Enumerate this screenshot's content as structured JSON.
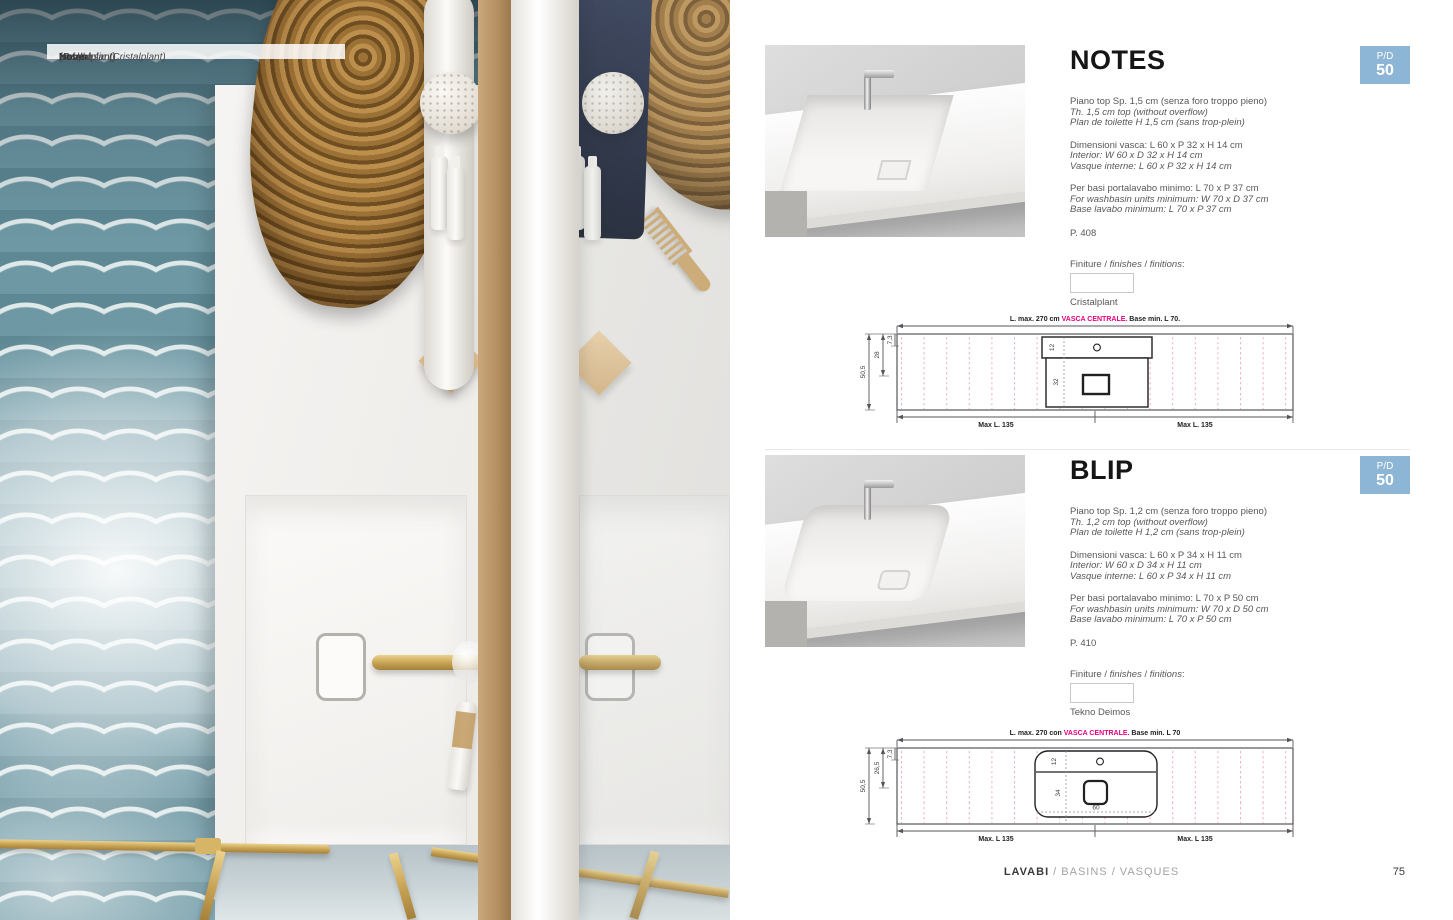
{
  "photo": {
    "caption": {
      "l1a": "Lavabo ",
      "l1b": "Notes",
      "l1c": " (Cristalplant)",
      "l2b": "Notes",
      "l2c": " washbasin (Cristalplant)",
      "l3a": "Vasque ",
      "l3b": "Notes",
      "l3c": " (Cristalplant)"
    }
  },
  "sections": [
    {
      "title": "NOTES",
      "badge": {
        "line1": "P/D",
        "line2": "50"
      },
      "specs": [
        {
          "l1": "Piano top Sp. 1,5 cm (senza foro troppo pieno)",
          "l2": "Th. 1,5 cm top (without overflow)",
          "l3": "Plan de toilette H 1,5 cm (sans trop-plein)"
        },
        {
          "l1": "Dimensioni vasca: L 60 x P 32 x H 14 cm",
          "l2": "Interior: W 60 x D 32 x H 14 cm",
          "l3": "Vasque interne: L 60 x P 32 x H 14 cm"
        },
        {
          "l1": "Per basi portalavabo minimo: L 70 x P 37 cm",
          "l2": "For washbasin units minimum: W 70 x D 37 cm",
          "l3": "Base lavabo minimum: L 70 x P 37 cm"
        }
      ],
      "page_ref": "P. 408",
      "finishes": {
        "pre": "Finiture / ",
        "f1": "finishes",
        "sep": " / ",
        "f2": "finitions",
        "colon": ":",
        "name": "Cristalplant"
      },
      "drawing": {
        "top_pre": "L. max. 270 cm ",
        "top_accent": "VASCA CENTRALE.",
        "top_post": " Base min. L 70.",
        "h_total": "50,5",
        "h_mid": "28",
        "h_top": "7,3",
        "basin_strip": "12",
        "basin_depth": "32",
        "max_left": "Max L. 135",
        "max_right": "Max L. 135"
      }
    },
    {
      "title": "BLIP",
      "badge": {
        "line1": "P/D",
        "line2": "50"
      },
      "specs": [
        {
          "l1": "Piano top Sp. 1,2 cm (senza foro troppo pieno)",
          "l2": "Th. 1,2 cm top (without overflow)",
          "l3": "Plan de toilette H 1,2 cm (sans trop-plein)"
        },
        {
          "l1": "Dimensioni vasca: L 60 x P 34 x H 11 cm",
          "l2": "Interior: W 60 x D 34 x H 11 cm",
          "l3": "Vasque interne: L 60 x P 34 x H 11 cm"
        },
        {
          "l1": "Per basi portalavabo minimo: L 70 x P 50 cm",
          "l2": "For washbasin units minimum: W 70 x D 50 cm",
          "l3": "Base lavabo minimum: L 70 x P 50 cm"
        }
      ],
      "page_ref": "P. 410",
      "finishes": {
        "pre": "Finiture / ",
        "f1": "finishes",
        "sep": " / ",
        "f2": "finitions",
        "colon": ":",
        "name": "Tekno Deimos"
      },
      "drawing": {
        "top_pre": "L. max. 270 con ",
        "top_accent": "VASCA CENTRALE.",
        "top_post": " Base min. L 70",
        "h_total": "50,5",
        "h_mid": "26,5",
        "h_top": "7,3",
        "basin_strip": "12",
        "basin_depth": "34",
        "basin_width": "60",
        "max_left": "Max. L 135",
        "max_right": "Max. L 135"
      }
    }
  ],
  "footer": {
    "primary": "LAVABI",
    "secondary": " / BASINS / VASQUES",
    "page_number": "75"
  },
  "colors": {
    "badge_blue": "#8db5d5",
    "accent_magenta": "#e6007e",
    "dashed_pink": "#f2a9c4"
  }
}
